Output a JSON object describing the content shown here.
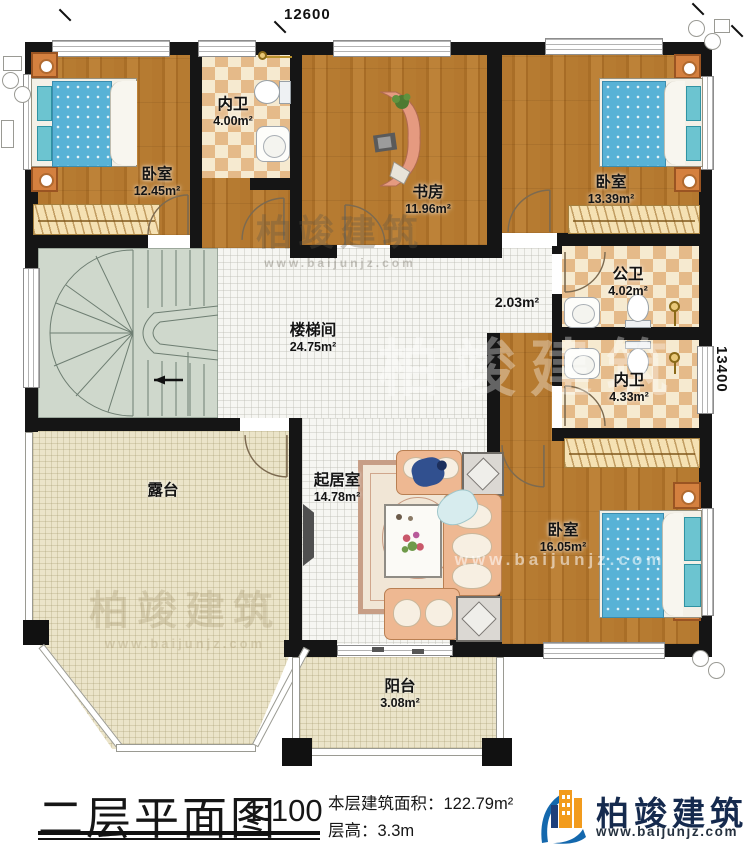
{
  "plan": {
    "dimensions": {
      "width": "12600",
      "height": "13400"
    },
    "rooms": {
      "bedroom_tl": {
        "name": "卧室",
        "area": "12.45m²"
      },
      "bath_top": {
        "name": "内卫",
        "area": "4.00m²"
      },
      "study": {
        "name": "书房",
        "area": "11.96m²"
      },
      "bedroom_tr": {
        "name": "卧室",
        "area": "13.39m²"
      },
      "stairwell": {
        "name": "楼梯间",
        "area": "24.75m²"
      },
      "hallway": {
        "area": "2.03m²"
      },
      "bath_public": {
        "name": "公卫",
        "area": "4.02m²"
      },
      "bath_inner": {
        "name": "内卫",
        "area": "4.33m²"
      },
      "terrace": {
        "name": "露台"
      },
      "living": {
        "name": "起居室",
        "area": "14.78m²"
      },
      "bedroom_br": {
        "name": "卧室",
        "area": "16.05m²"
      },
      "balcony": {
        "name": "阳台",
        "area": "3.08m²"
      }
    }
  },
  "title_block": {
    "title": "二层平面图",
    "scale": "1:100",
    "area_label": "本层建筑面积：",
    "area_value": "122.79m²",
    "floor_height_label": "层高：",
    "floor_height_value": "3.3m"
  },
  "brand": {
    "name": "柏竣建筑",
    "url": "www.baijunjz.com"
  },
  "colors": {
    "accent_blue": "#1468ad",
    "accent_orange": "#f29b1d",
    "wall": "#151515",
    "wood": "#b1762f"
  }
}
